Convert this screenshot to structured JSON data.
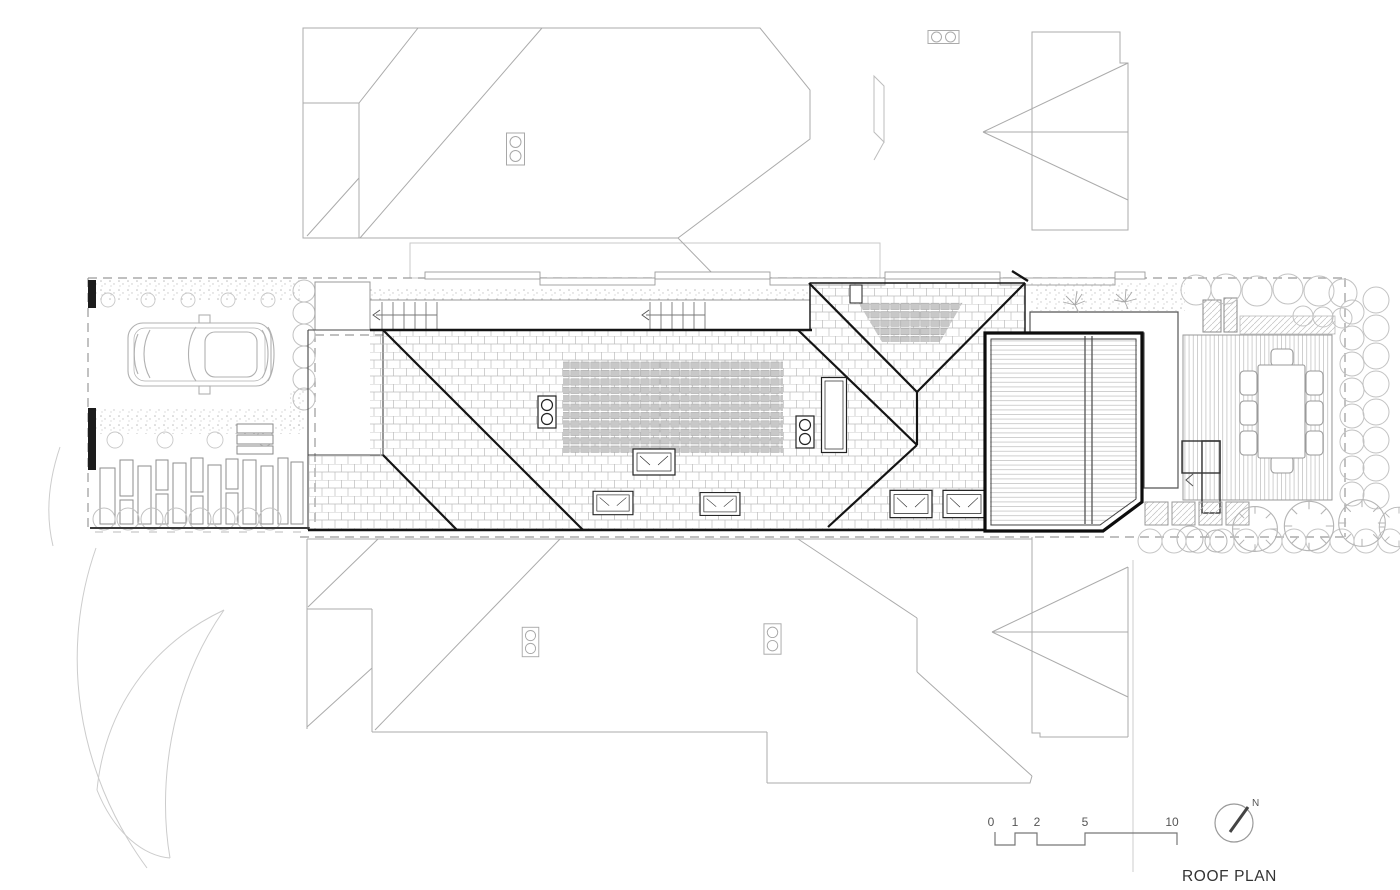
{
  "drawing": {
    "title": "ROOF PLAN",
    "north_label": "N",
    "scale_bar": {
      "labels": [
        "0",
        "1",
        "2",
        "5",
        "10"
      ]
    }
  },
  "colors": {
    "background": "#ffffff",
    "subject_outline": "#141414",
    "neighbor_outline": "#ababab",
    "vegetation": "#c4c4c4",
    "boundary_dash": "#9a9a9a",
    "solar_panel_fill": "#c8c8c8",
    "label_text": "#3c3c3c"
  }
}
